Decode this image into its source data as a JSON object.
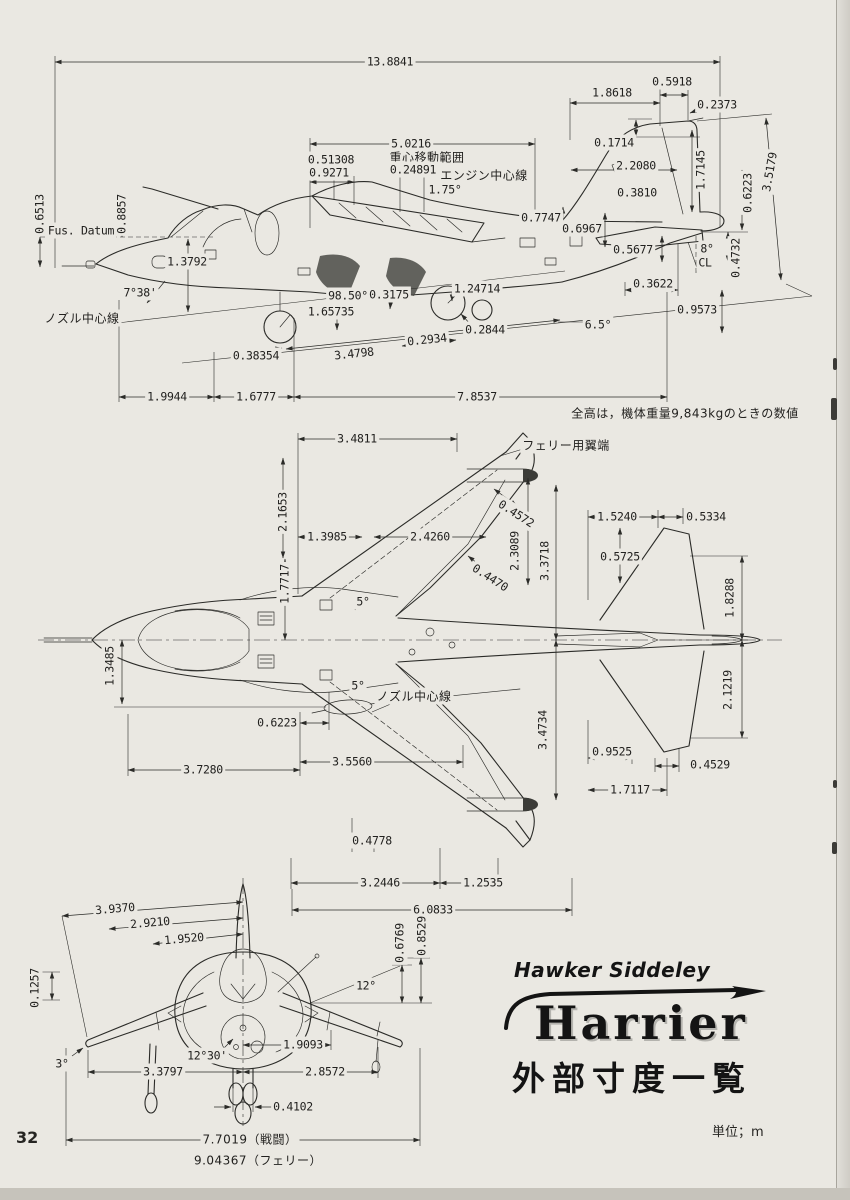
{
  "page": {
    "number": "32",
    "unit_label": "単位；m"
  },
  "logo": {
    "brand": "Hawker Siddeley",
    "model": "Harrier",
    "subtitle": "外部寸度一覧"
  },
  "views": {
    "side": {
      "labels": [
        {
          "t": "13.8841",
          "x": 390,
          "y": 62
        },
        {
          "t": "0.5918",
          "x": 672,
          "y": 82
        },
        {
          "t": "1.8618",
          "x": 612,
          "y": 93
        },
        {
          "t": "0.2373",
          "x": 717,
          "y": 105
        },
        {
          "t": "0.1714",
          "x": 614,
          "y": 143
        },
        {
          "t": "1.7145",
          "x": 701,
          "y": 170,
          "r": -90
        },
        {
          "t": "2.2080",
          "x": 636,
          "y": 166
        },
        {
          "t": "3.5179",
          "x": 770,
          "y": 172,
          "r": -80
        },
        {
          "t": "0.6223",
          "x": 748,
          "y": 193,
          "r": -90
        },
        {
          "t": "0.3810",
          "x": 637,
          "y": 193
        },
        {
          "t": "5.0216",
          "x": 411,
          "y": 144
        },
        {
          "t": "0.51308",
          "x": 331,
          "y": 160
        },
        {
          "t": "重心移動範囲",
          "x": 427,
          "y": 158,
          "jp": 1
        },
        {
          "t": "0.9271",
          "x": 329,
          "y": 173
        },
        {
          "t": "0.24891",
          "x": 413,
          "y": 170
        },
        {
          "t": "エンジン中心線",
          "x": 484,
          "y": 176,
          "jp": 1
        },
        {
          "t": "1.75°",
          "x": 445,
          "y": 190
        },
        {
          "t": "0.7747",
          "x": 541,
          "y": 218
        },
        {
          "t": "0.6967",
          "x": 582,
          "y": 229
        },
        {
          "t": "0.6513",
          "x": 40,
          "y": 214,
          "r": -90
        },
        {
          "t": "0.8857",
          "x": 122,
          "y": 214,
          "r": -90
        },
        {
          "t": "Fus. Datum",
          "x": 81,
          "y": 231
        },
        {
          "t": "1.3792",
          "x": 187,
          "y": 262
        },
        {
          "t": "0.5677",
          "x": 633,
          "y": 250
        },
        {
          "t": "8°",
          "x": 707,
          "y": 249
        },
        {
          "t": "CL",
          "x": 705,
          "y": 263
        },
        {
          "t": "0.4732",
          "x": 736,
          "y": 258,
          "r": -90
        },
        {
          "t": "0.3622",
          "x": 653,
          "y": 284
        },
        {
          "t": "0.9573",
          "x": 697,
          "y": 310
        },
        {
          "t": "7°38'",
          "x": 140,
          "y": 293
        },
        {
          "t": "98.50°",
          "x": 348,
          "y": 296
        },
        {
          "t": "0.3175",
          "x": 389,
          "y": 295
        },
        {
          "t": "1.24714",
          "x": 477,
          "y": 289
        },
        {
          "t": "1.65735",
          "x": 331,
          "y": 312
        },
        {
          "t": "ノズル中心線",
          "x": 82,
          "y": 319,
          "jp": 1
        },
        {
          "t": "0.2844",
          "x": 485,
          "y": 330
        },
        {
          "t": "6.5°",
          "x": 598,
          "y": 325
        },
        {
          "t": "0.2934",
          "x": 427,
          "y": 340,
          "r": -6
        },
        {
          "t": "0.38354",
          "x": 256,
          "y": 356
        },
        {
          "t": "3.4798",
          "x": 354,
          "y": 354,
          "r": -6
        },
        {
          "t": "1.9944",
          "x": 167,
          "y": 397
        },
        {
          "t": "1.6777",
          "x": 256,
          "y": 397
        },
        {
          "t": "7.8537",
          "x": 477,
          "y": 397
        },
        {
          "t": "全高は，機体重量9,843kgのときの数値",
          "x": 685,
          "y": 414,
          "jp": 1
        }
      ]
    },
    "plan": {
      "labels": [
        {
          "t": "3.4811",
          "x": 357,
          "y": 439
        },
        {
          "t": "フェリー用翼端",
          "x": 566,
          "y": 446,
          "jp": 1
        },
        {
          "t": "2.1653",
          "x": 283,
          "y": 512,
          "r": -90
        },
        {
          "t": "1.3985",
          "x": 327,
          "y": 537
        },
        {
          "t": "2.4260",
          "x": 430,
          "y": 537
        },
        {
          "t": "0.4572",
          "x": 516,
          "y": 514,
          "r": 33
        },
        {
          "t": "2.3089",
          "x": 515,
          "y": 551,
          "r": -90
        },
        {
          "t": "3.3718",
          "x": 545,
          "y": 561,
          "r": -90
        },
        {
          "t": "0.4470",
          "x": 490,
          "y": 578,
          "r": 33
        },
        {
          "t": "1.7717",
          "x": 285,
          "y": 584,
          "r": -90
        },
        {
          "t": "1.5240",
          "x": 617,
          "y": 517
        },
        {
          "t": "0.5334",
          "x": 706,
          "y": 517
        },
        {
          "t": "0.5725",
          "x": 620,
          "y": 557
        },
        {
          "t": "1.8288",
          "x": 730,
          "y": 598,
          "r": -90
        },
        {
          "t": "5°",
          "x": 363,
          "y": 602
        },
        {
          "t": "1.3485",
          "x": 110,
          "y": 666,
          "r": -90
        },
        {
          "t": "5°",
          "x": 358,
          "y": 686
        },
        {
          "t": "ノズル中心線",
          "x": 414,
          "y": 697,
          "jp": 1
        },
        {
          "t": "0.6223",
          "x": 277,
          "y": 723
        },
        {
          "t": "3.4734",
          "x": 543,
          "y": 730,
          "r": -90
        },
        {
          "t": "2.1219",
          "x": 728,
          "y": 690,
          "r": -90
        },
        {
          "t": "0.9525",
          "x": 612,
          "y": 752
        },
        {
          "t": "0.4529",
          "x": 710,
          "y": 765
        },
        {
          "t": "3.7280",
          "x": 203,
          "y": 770
        },
        {
          "t": "3.5560",
          "x": 352,
          "y": 762
        },
        {
          "t": "1.7117",
          "x": 630,
          "y": 790
        },
        {
          "t": "0.4778",
          "x": 372,
          "y": 841
        },
        {
          "t": "3.2446",
          "x": 380,
          "y": 883
        },
        {
          "t": "1.2535",
          "x": 483,
          "y": 883
        },
        {
          "t": "6.0833",
          "x": 433,
          "y": 910
        }
      ]
    },
    "front": {
      "labels": [
        {
          "t": "3.9370",
          "x": 115,
          "y": 909,
          "r": -5
        },
        {
          "t": "2.9210",
          "x": 150,
          "y": 923,
          "r": -5
        },
        {
          "t": "1.9520",
          "x": 184,
          "y": 939,
          "r": -5
        },
        {
          "t": "0.6769",
          "x": 400,
          "y": 943,
          "r": -90
        },
        {
          "t": "0.8529",
          "x": 422,
          "y": 936,
          "r": -90
        },
        {
          "t": "0.1257",
          "x": 35,
          "y": 988,
          "r": -90
        },
        {
          "t": "12°",
          "x": 366,
          "y": 986
        },
        {
          "t": "12°30'",
          "x": 207,
          "y": 1056
        },
        {
          "t": "3°",
          "x": 62,
          "y": 1064
        },
        {
          "t": "1.9093",
          "x": 303,
          "y": 1045
        },
        {
          "t": "3.3797",
          "x": 163,
          "y": 1072
        },
        {
          "t": "2.8572",
          "x": 325,
          "y": 1072
        },
        {
          "t": "0.4102",
          "x": 293,
          "y": 1107
        },
        {
          "t": "7.7019（戦闘）",
          "x": 250,
          "y": 1140,
          "jp": 1
        },
        {
          "t": "9.04367（フェリー）",
          "x": 258,
          "y": 1161,
          "jp": 1
        }
      ]
    }
  }
}
